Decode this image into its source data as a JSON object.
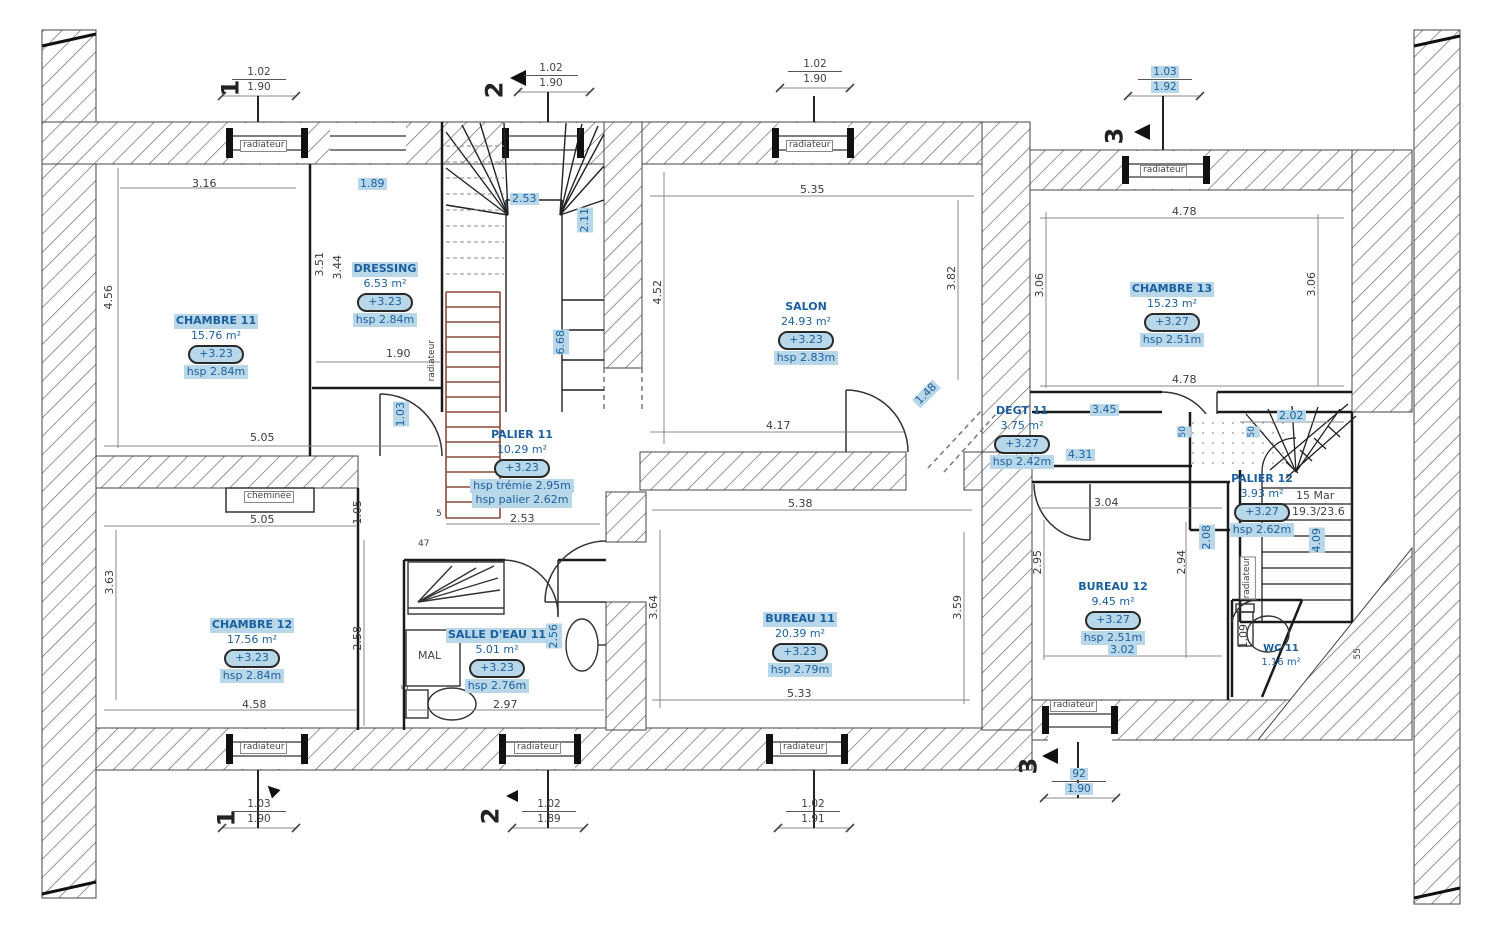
{
  "drawing": {
    "highlight_bg": "#b8d7e8",
    "highlight_text": "#1b5f9e",
    "wall_line_color": "#222222",
    "stair_wood_color": "#8a4a3a"
  },
  "rooms": [
    {
      "id": "chambre11",
      "name": "CHAMBRE 11",
      "area": "15.76 m²",
      "level": "+3.23",
      "hsp": "hsp 2.84m"
    },
    {
      "id": "dressing",
      "name": "DRESSING",
      "area": "6.53 m²",
      "level": "+3.23",
      "hsp": "hsp 2.84m"
    },
    {
      "id": "salon",
      "name": "SALON",
      "area": "24.93 m²",
      "level": "+3.23",
      "hsp": "hsp 2.83m"
    },
    {
      "id": "chambre13",
      "name": "CHAMBRE 13",
      "area": "15.23 m²",
      "level": "+3.27",
      "hsp": "hsp 2.51m"
    },
    {
      "id": "palier11",
      "name": "PALIER 11",
      "area": "10.29 m²",
      "level": "+3.23",
      "hsp": "hsp trémie 2.95m",
      "hsp2": "hsp palier 2.62m"
    },
    {
      "id": "degt11",
      "name": "DEGT 11",
      "area": "3.75 m²",
      "level": "+3.27",
      "hsp": "hsp 2.42m"
    },
    {
      "id": "palier12",
      "name": "PALIER 12",
      "area": "3.93 m²",
      "level": "+3.27",
      "hsp": "hsp 2.62m"
    },
    {
      "id": "chambre12",
      "name": "CHAMBRE 12",
      "area": "17.56 m²",
      "level": "+3.23",
      "hsp": "hsp 2.84m"
    },
    {
      "id": "salle_eau11",
      "name": "SALLE D'EAU 11",
      "area": "5.01 m²",
      "level": "+3.23",
      "hsp": "hsp 2.76m"
    },
    {
      "id": "bureau11",
      "name": "BUREAU 11",
      "area": "20.39 m²",
      "level": "+3.23",
      "hsp": "hsp 2.79m"
    },
    {
      "id": "bureau12",
      "name": "BUREAU 12",
      "area": "9.45 m²",
      "level": "+3.27",
      "hsp": "hsp 2.51m"
    },
    {
      "id": "wc11",
      "name": "WC 11",
      "area": "1.16 m²"
    }
  ],
  "markers": {
    "m1": "1",
    "m2": "2",
    "m3": "3"
  },
  "marker_dims": {
    "top1_a": "1.02",
    "top1_b": "1.90",
    "top2_a": "1.02",
    "top2_b": "1.90",
    "topmid_a": "1.02",
    "topmid_b": "1.90",
    "top3_a": "1.03",
    "top3_b": "1.92",
    "bot1_a": "1.03",
    "bot1_b": "1.90",
    "bot2_a": "1.02",
    "bot2_b": "1.89",
    "botmid_a": "1.02",
    "botmid_b": "1.91",
    "bot3_a": "92",
    "bot3_b": "1.90"
  },
  "dims": {
    "chambre11_top": "3.16",
    "chambre11_left": "4.56",
    "chambre11_bottom": "5.05",
    "dressing_top": "1.89",
    "dressing_left_a": "3.51",
    "dressing_left_b": "3.44",
    "dressing_width": "1.90",
    "stair_top": "2.53",
    "stair_right": "2.11",
    "palier_height": "6.68",
    "palier_door": "1.03",
    "salon_top": "5.35",
    "salon_left": "4.52",
    "salon_right": "3.82",
    "salon_bottom": "4.17",
    "salon_diag": "1.48",
    "chambre13_top": "4.78",
    "chambre13_left": "3.06",
    "chambre13_right": "3.06",
    "chambre13_bottom": "4.78",
    "degt_a": "3.45",
    "degt_b": "4.31",
    "palier12_top": "2.02",
    "small_50a": "50",
    "small_50b": "50",
    "chambre12_top": "5.05",
    "chambre12_gap": "1.05",
    "chambre12_left": "3.63",
    "chambre12_right": "2.58",
    "chambre12_bottom": "4.58",
    "sde_top": "2.53",
    "sde_small_a": "5",
    "sde_small_b": "47",
    "sde_small_c": "5",
    "sde_bottom": "2.97",
    "sde_right": "2.56",
    "bureau11_top": "5.38",
    "bureau11_left": "3.64",
    "bureau11_right": "3.59",
    "bureau11_bottom": "5.33",
    "bureau12_top": "3.04",
    "bureau12_left": "2.95",
    "bureau12_right": "2.94",
    "bureau12_bottom": "3.02",
    "stair2_left": "2.08",
    "stair2_right": "4.09",
    "wc_left": "1.09",
    "wc_small": "55"
  },
  "annotations": {
    "radiateur": "radiateur",
    "cheminee": "cheminée",
    "mal": "MAL",
    "stair_steps": "15 Mar",
    "stair_ratio": "19.3/23.6"
  }
}
